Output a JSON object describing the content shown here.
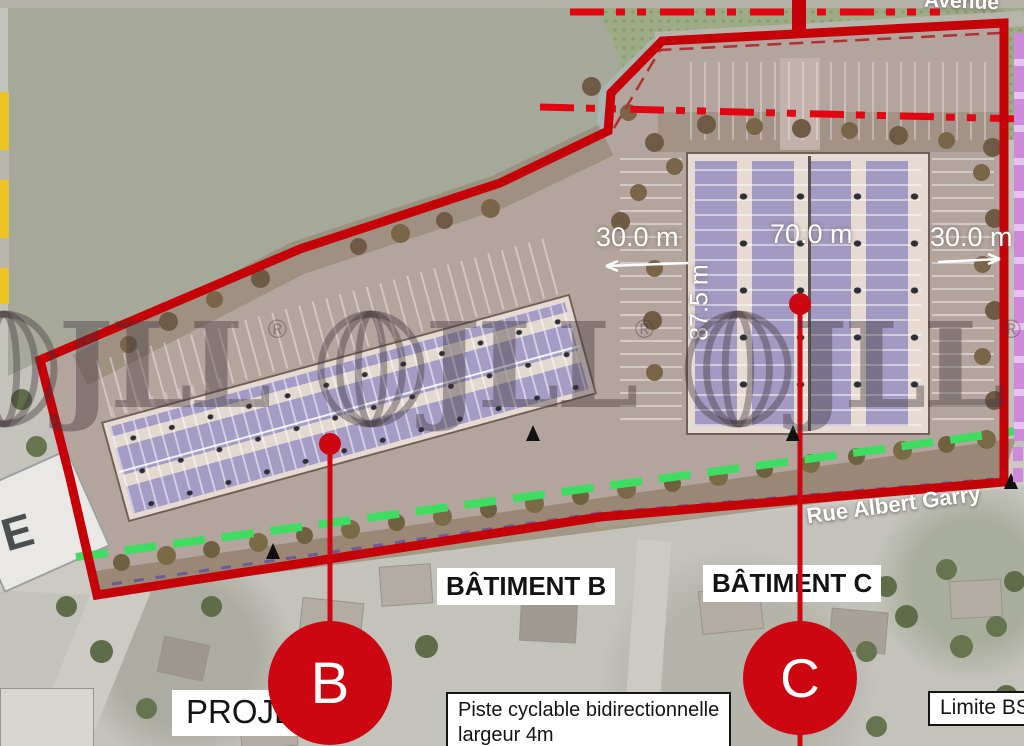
{
  "watermark": {
    "brand": "JLL",
    "registered": "®"
  },
  "labels": {
    "avenue": "Avenue",
    "street": "Rue Albert Garry",
    "building_b": "BÂTIMENT B",
    "building_c": "BÂTIMENT C",
    "marker_b": "B",
    "marker_c": "C",
    "project": "PROJE",
    "cycle_path_line1": "Piste cyclable bidirectionnelle",
    "cycle_path_line2": "largeur 4m",
    "limit": "Limite BS",
    "existing_building": "E"
  },
  "dimensions": {
    "west_setback": "30.0 m",
    "building_c_width": "70.0 m",
    "east_setback": "30.0 m",
    "building_c_depth": "87.5 m"
  },
  "colors": {
    "boundary_red": "#c50208",
    "dash_dot_red": "#e20613",
    "cycle_green": "#3edc60",
    "marker_red": "#cc0712",
    "zone_magenta": "#cf89da",
    "setback_purple": "#6a5a96",
    "masked_area": "#a6a999",
    "site_ground": "#b3a49d"
  }
}
